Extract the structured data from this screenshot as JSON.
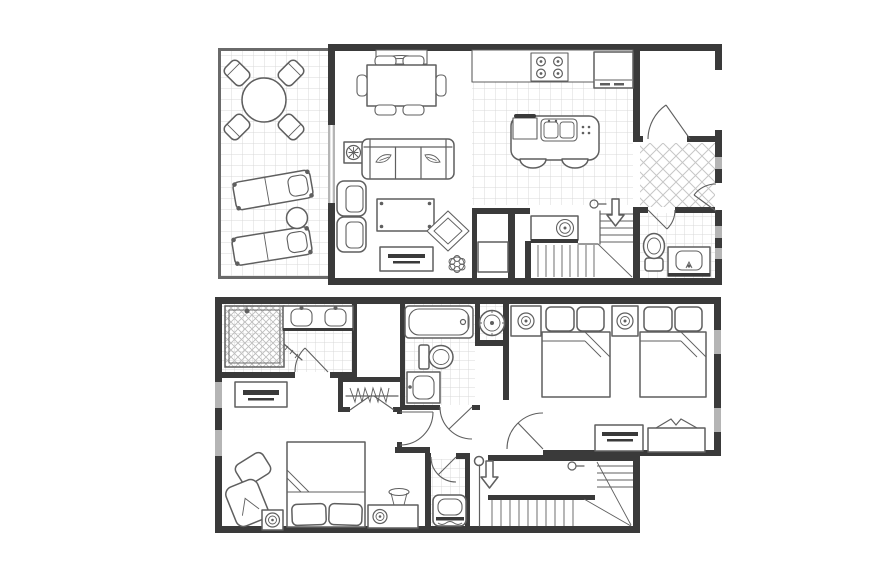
{
  "title": "Two-level suite floor plan",
  "canvas": {
    "width": 876,
    "height": 584,
    "background": "#ffffff"
  },
  "colors": {
    "wall": "#3a3a3a",
    "wallmed": "#6a6a6a",
    "furn": "#5f5f5f",
    "tile": "#d8d8d8",
    "tilex": "#c6c6c6",
    "window": "#b5b5b5"
  },
  "floors": [
    {
      "id": "upper",
      "name": "main-level",
      "rooms": [
        {
          "name": "patio",
          "flooring": "grid-tile",
          "furniture": [
            "round-patio-table",
            "patio-chair x4",
            "chaise-lounge x2",
            "patio-side-table"
          ]
        },
        {
          "name": "living-dining",
          "flooring": "carpet",
          "furniture": [
            "buffet-sideboard",
            "dining-table",
            "dining-chair x6",
            "sofa",
            "armchair x2",
            "plant-side-table",
            "coffee-table",
            "accent-rug",
            "tv-console",
            "floor-plant"
          ]
        },
        {
          "name": "kitchen",
          "flooring": "grid-tile",
          "furniture": [
            "counter",
            "cooktop",
            "refrigerator",
            "island-with-sink",
            "bar-stool x2"
          ]
        },
        {
          "name": "laundry-closet",
          "flooring": "hard",
          "furniture": [
            "counter",
            "washer",
            "utility-unit"
          ]
        },
        {
          "name": "stairs",
          "symbols": [
            "down-arrow",
            "railing-curl"
          ]
        },
        {
          "name": "storage-closet",
          "furniture": [
            "door-swing"
          ]
        },
        {
          "name": "entry-foyer",
          "flooring": "diagonal-tile",
          "furniture": [
            "entry-door-swing"
          ]
        },
        {
          "name": "powder-room",
          "flooring": "grid-tile",
          "furniture": [
            "toilet",
            "vanity-sink"
          ]
        }
      ]
    },
    {
      "id": "lower",
      "name": "bedroom-level",
      "rooms": [
        {
          "name": "primary-bathroom",
          "flooring": "grid-tile",
          "furniture": [
            "walk-in-shower",
            "shower-head",
            "glass-door",
            "double-vanity",
            "sink x2"
          ]
        },
        {
          "name": "walk-in-closet",
          "furniture": [
            "hanging-rod-with-hangers",
            "double-doors"
          ]
        },
        {
          "name": "bathroom-2",
          "flooring": "grid-tile",
          "furniture": [
            "bathtub",
            "toilet",
            "vanity-sink"
          ]
        },
        {
          "name": "utility-alcove",
          "furniture": [
            "water-heater"
          ]
        },
        {
          "name": "bedroom-2",
          "flooring": "carpet",
          "furniture": [
            "double-bed x2",
            "nightstand-with-lamp x2",
            "tv-console",
            "luggage-bench"
          ]
        },
        {
          "name": "primary-bedroom",
          "flooring": "carpet",
          "furniture": [
            "bed",
            "pillow x2",
            "chaise-chair",
            "ottoman",
            "nightstand-with-lamp",
            "dresser-with-tv",
            "desk-with-lamps"
          ]
        },
        {
          "name": "closet",
          "flooring": "grid-tile",
          "furniture": [
            "crib-bench"
          ]
        },
        {
          "name": "stairs",
          "symbols": [
            "down-arrow",
            "railing-curl",
            "banister"
          ]
        }
      ]
    }
  ]
}
